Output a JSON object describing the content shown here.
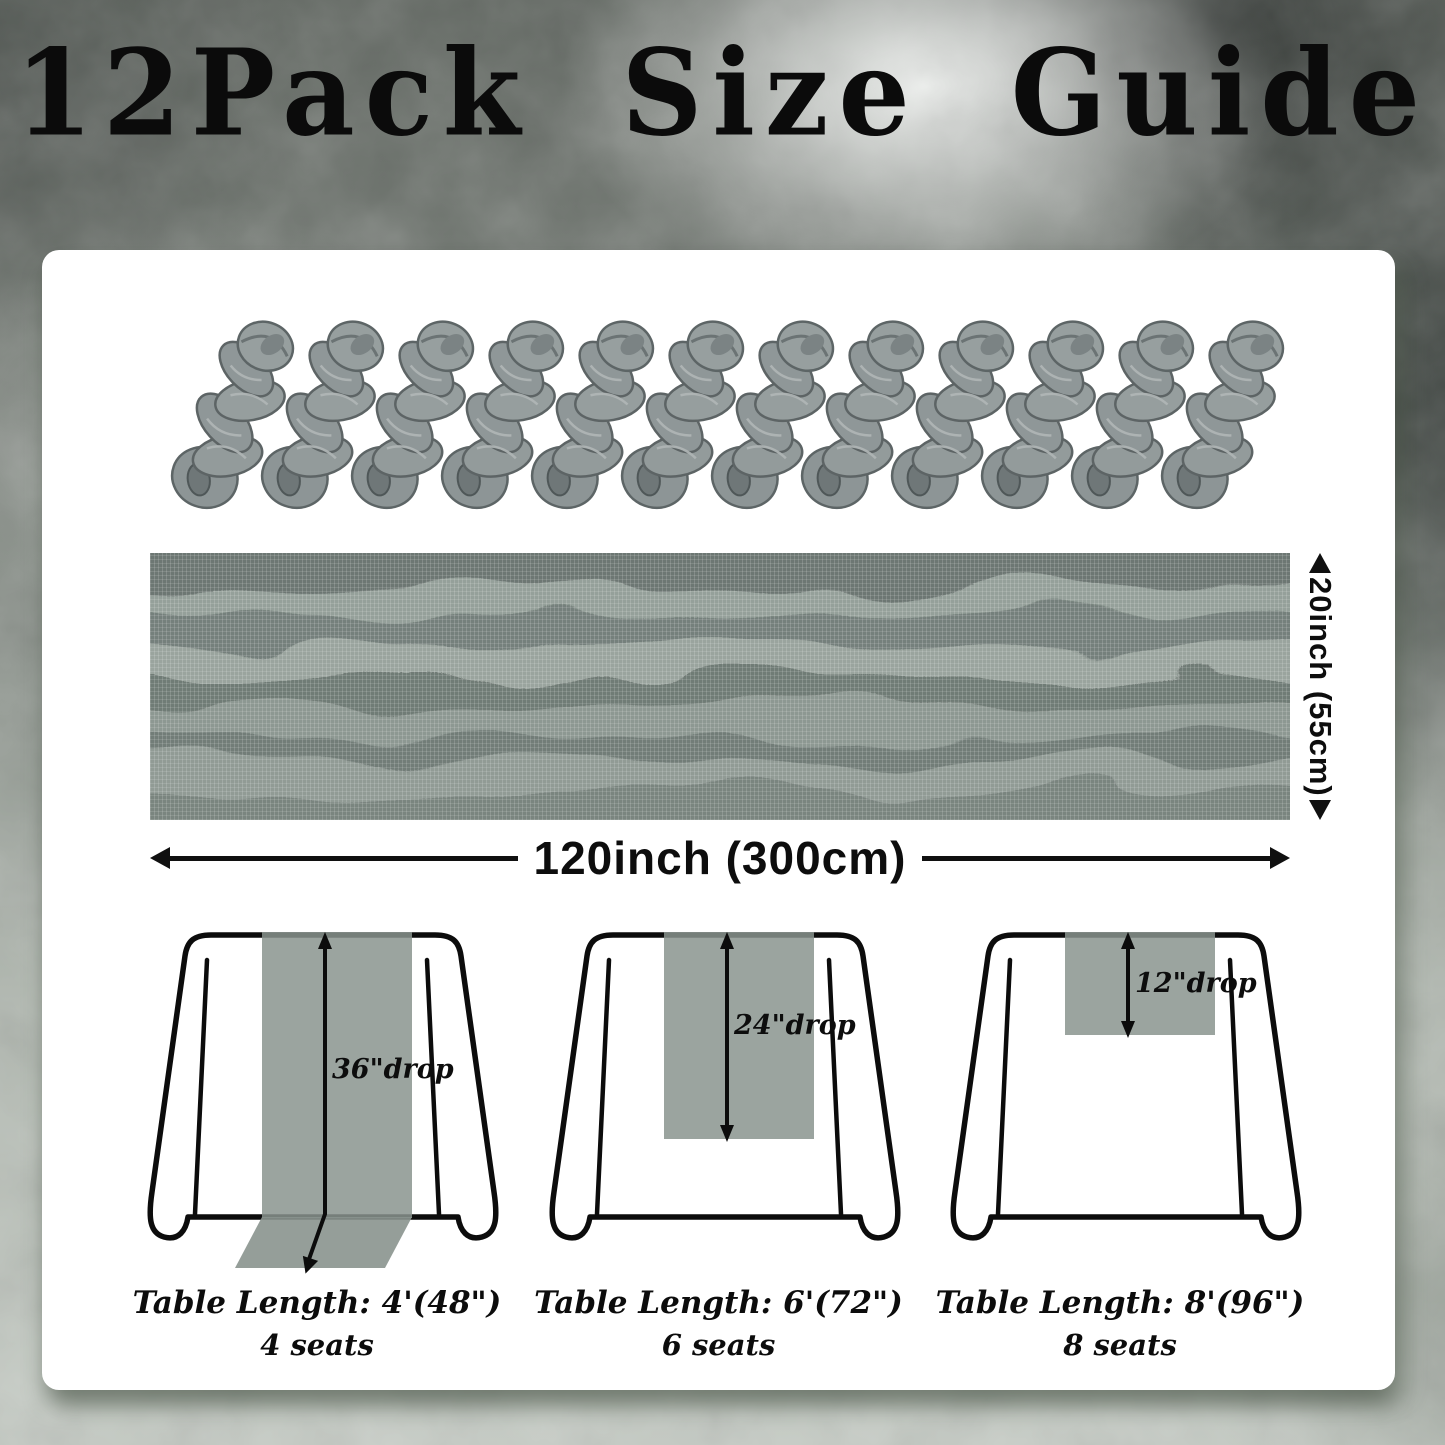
{
  "title": "12Pack Size Guide",
  "product": {
    "pack_count": 12
  },
  "colors": {
    "fabric": "#8a948e",
    "card": "#ffffff",
    "ink": "#0c0c0c",
    "background_dark": "#5f655f",
    "background_light": "#c6ccc5"
  },
  "dimensions": {
    "width_label": "120inch (300cm)",
    "height_label": "20inch (55cm)"
  },
  "tables": [
    {
      "drop_label": "36\"drop",
      "length_label": "Table Length: 4'(48\")",
      "seats_label": "4 seats"
    },
    {
      "drop_label": "24\"drop",
      "length_label": "Table Length: 6'(72\")",
      "seats_label": "6 seats"
    },
    {
      "drop_label": "12\"drop",
      "length_label": "Table Length: 8'(96\")",
      "seats_label": "8 seats"
    }
  ]
}
